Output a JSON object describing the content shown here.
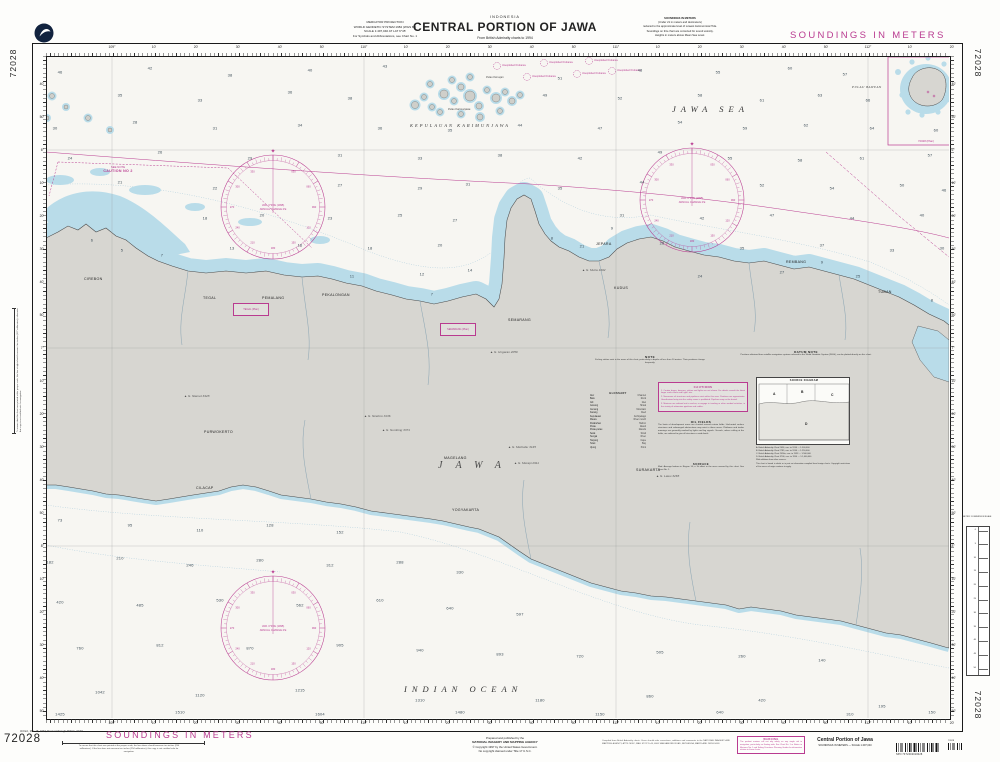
{
  "chart_number": "72028",
  "header": {
    "projection_lines": [
      "MERCATOR PROJECTION",
      "WORLD GEODETIC SYSTEM 1984 (WGS 84)",
      "SCALE 1:497,040 AT LAT 6°45'",
      "For Symbols and Abbreviations, see Chart No. 1"
    ],
    "country": "INDONESIA",
    "title": "CENTRAL PORTION OF JAWA",
    "subtitle": "From British Admiralty charts to 1994",
    "soundings_note_lines": [
      "SOUNDINGS IN METERS",
      "(Under 21 in meters and decimeters)",
      "reduced to the approximate level of Lowest Astronomical Tide.",
      "Soundings on this chart are corrected for sound velocity.",
      "Heights in meters above Mean Sea Level."
    ],
    "banner": "SOUNDINGS IN METERS"
  },
  "margins": {
    "lon_labels": [
      "109°",
      "10'",
      "20'",
      "30'",
      "40'",
      "50'",
      "110°",
      "10'",
      "20'",
      "30'",
      "40'",
      "50'",
      "111°",
      "10'",
      "20'",
      "30'",
      "40'",
      "50'",
      "112°",
      "10'",
      "20'"
    ],
    "lat_labels": [
      "40'",
      "50'",
      "6°",
      "10'",
      "20'",
      "30'",
      "40'",
      "50'",
      "7°",
      "10'",
      "20'",
      "30'",
      "40'",
      "50'",
      "8°",
      "10'",
      "20'",
      "30'",
      "40'",
      "50'"
    ],
    "scale_check": "To ensure that this chart was printed at the proper scale, the line above should measure ten inches (254 millimeters). If the line does not measure ten inches (254 millimeters), this copy is not certified safe for navigation.",
    "scale_check_vertical": "To ensure that this chart was printed at the proper scale, the line at right should measure five inches (127 millimeters); otherwise this copy is not certified safe for navigation.",
    "metric_scale_title": "METRIC CONVERSION SCALE",
    "metric_scale_values": [
      "0",
      "5",
      "10",
      "15",
      "20",
      "25",
      "30",
      "35",
      "40",
      "45",
      "50"
    ]
  },
  "map": {
    "sea_labels": {
      "jawa_sea": "JAWA SEA",
      "indian_ocean": "INDIAN OCEAN",
      "karimunjawa": "KEPULAUAN KARIMUNJAWA",
      "jawa": "JAWA",
      "bawean": "PULAU BAWEAN",
      "bawean_plan": "72028 (Plan)"
    },
    "island_labels": [
      {
        "n": "Pulau Karimunjawa",
        "x": 448,
        "y": 108
      },
      {
        "n": "Pulau Kemujan",
        "x": 486,
        "y": 76
      }
    ],
    "caution_label": {
      "line1": "SEE NOTE",
      "line2": "CAUTION NO 2"
    },
    "ordnance_label": "Unexploded Ordnance",
    "ordnance_points": [
      [
        497,
        66
      ],
      [
        544,
        63
      ],
      [
        589,
        61
      ],
      [
        527,
        77
      ],
      [
        577,
        74
      ],
      [
        612,
        71
      ]
    ],
    "rose": {
      "line1": "VAR. 0°45'E (1995)",
      "line2": "ANNUAL CHANGE 2'E"
    },
    "plan_boxes": [
      {
        "label": "TEGAL (Plan)",
        "x": 233,
        "y": 303
      },
      {
        "label": "SEMARANG (Plan)",
        "x": 440,
        "y": 323
      }
    ],
    "cities": [
      {
        "n": "CIREBON",
        "x": 84,
        "y": 277
      },
      {
        "n": "TEGAL",
        "x": 203,
        "y": 296
      },
      {
        "n": "PEMALANG",
        "x": 262,
        "y": 296
      },
      {
        "n": "PEKALONGAN",
        "x": 322,
        "y": 293
      },
      {
        "n": "SEMARANG",
        "x": 508,
        "y": 318
      },
      {
        "n": "JEPARA",
        "x": 596,
        "y": 242
      },
      {
        "n": "KUDUS",
        "x": 614,
        "y": 286
      },
      {
        "n": "REMBANG",
        "x": 786,
        "y": 260
      },
      {
        "n": "TUBAN",
        "x": 878,
        "y": 290
      },
      {
        "n": "CILACAP",
        "x": 196,
        "y": 486
      },
      {
        "n": "YOGYAKARTA",
        "x": 452,
        "y": 508
      },
      {
        "n": "SURAKARTA",
        "x": 636,
        "y": 468
      },
      {
        "n": "MAGELANG",
        "x": 444,
        "y": 456
      },
      {
        "n": "PURWOKERTO",
        "x": 204,
        "y": 430
      }
    ],
    "peaks": [
      {
        "n": "G. Slamet 3428",
        "x": 184,
        "y": 394
      },
      {
        "n": "G. Sindoro 3136",
        "x": 364,
        "y": 414
      },
      {
        "n": "G. Sumbing 3371",
        "x": 382,
        "y": 428
      },
      {
        "n": "G. Merbabu 3145",
        "x": 508,
        "y": 445
      },
      {
        "n": "G. Merapi 2911",
        "x": 514,
        "y": 461
      },
      {
        "n": "G. Lawu 3265",
        "x": 656,
        "y": 474
      },
      {
        "n": "G. Muria 1602",
        "x": 582,
        "y": 268
      },
      {
        "n": "G. Ungaran 2050",
        "x": 490,
        "y": 350
      }
    ],
    "notes": {
      "note": {
        "title": "NOTE",
        "body": "Fishing stakes exist in the areas of this chart, particularly in depths of less than 10 meters. Their positions change frequently."
      },
      "datum": {
        "title": "DATUM NOTE",
        "body": "Positions obtained from satellite navigation systems referred to the World Geodetic System (WGS), can be plotted directly on this chart."
      },
      "cautions": {
        "title": "CAUTIONS",
        "items": [
          "1. Certain buoys, beacons, stakes and lights are not shown. For details consult the latest larger scale charts and Light Lists.",
          "2. Numerous oil structures and pipelines exist within this area. Positions are approximate. Unauthorized entry into the safety zones is prohibited. Pipelines may not be buried.",
          "3. Mariners are advised not to anchor, or engage in trawling or other seabed activities, in the vicinity of submarine pipelines and cables."
        ]
      },
      "oil": {
        "title": "OIL FIELDS",
        "body": "The limits of development areas are charted around certain fields. Uncharted surface structures and submerged obstructions may exist in these areas. Platforms and tanker moorings are generally marked by lights and fog signals. Vessels, unless calling at the fields, are advised to give all structures a wide berth."
      },
      "surface": {
        "title": "SURFACE",
        "body": "Mud. Average bottom in Region 14; a 1h effect in the area covered by this chart. See Chart No. 1."
      },
      "glossary": {
        "title": "GLOSSARY",
        "items": [
          [
            "Alur",
            "Channel"
          ],
          [
            "Batu",
            "Rock"
          ],
          [
            "Gili",
            "Islet"
          ],
          [
            "Gosong",
            "Shoal"
          ],
          [
            "Gunung",
            "Mountain"
          ],
          [
            "Karang",
            "Reef"
          ],
          [
            "Kepulauan",
            "Archipelago"
          ],
          [
            "Muara",
            "River mouth"
          ],
          [
            "Pelabuhan",
            "Harbor"
          ],
          [
            "Pulau",
            "Island"
          ],
          [
            "Pulau-pulau",
            "Islands"
          ],
          [
            "Selat",
            "Strait"
          ],
          [
            "Sungai",
            "River"
          ],
          [
            "Tanjung",
            "Cape"
          ],
          [
            "Teluk",
            "Bay"
          ],
          [
            "Ujung",
            "Point"
          ]
        ]
      },
      "source": {
        "title": "SOURCE DIAGRAM",
        "regions": [
          "A",
          "B",
          "C",
          "D"
        ],
        "lines": [
          "A. British Admiralty Chart 2056, corr. to 1994 — 1:500,000",
          "B. British Admiralty Chart 2785, corr. to 1994 — 1:250,000",
          "C. British Admiralty Chart 2056a, corr. to 1993 — 1:500,000",
          "D. British Admiralty Chart 3706, corr. to 1994 — 1:1,000,000"
        ],
        "note": "With additions from other sources.",
        "footnote": "This chart is based in whole or in part on information compiled from foreign charts. Copyright restrictions of the source of origin continue to apply."
      }
    },
    "soundings": [
      [
        60,
        72,
        "46"
      ],
      [
        150,
        68,
        "42"
      ],
      [
        230,
        75,
        "38"
      ],
      [
        310,
        70,
        "40"
      ],
      [
        385,
        66,
        "43"
      ],
      [
        560,
        78,
        "51"
      ],
      [
        640,
        70,
        "48"
      ],
      [
        718,
        72,
        "55"
      ],
      [
        790,
        68,
        "60"
      ],
      [
        845,
        74,
        "57"
      ],
      [
        45,
        98,
        "37"
      ],
      [
        120,
        95,
        "35"
      ],
      [
        200,
        100,
        "33"
      ],
      [
        290,
        92,
        "36"
      ],
      [
        350,
        98,
        "38"
      ],
      [
        545,
        95,
        "49"
      ],
      [
        620,
        98,
        "52"
      ],
      [
        700,
        95,
        "58"
      ],
      [
        762,
        100,
        "61"
      ],
      [
        820,
        95,
        "63"
      ],
      [
        868,
        100,
        "66"
      ],
      [
        55,
        128,
        "30"
      ],
      [
        135,
        122,
        "28"
      ],
      [
        215,
        128,
        "31"
      ],
      [
        300,
        125,
        "34"
      ],
      [
        380,
        128,
        "36"
      ],
      [
        450,
        130,
        "35"
      ],
      [
        520,
        125,
        "44"
      ],
      [
        600,
        128,
        "47"
      ],
      [
        680,
        122,
        "54"
      ],
      [
        745,
        128,
        "59"
      ],
      [
        806,
        125,
        "62"
      ],
      [
        872,
        128,
        "64"
      ],
      [
        936,
        130,
        "60"
      ],
      [
        70,
        158,
        "24"
      ],
      [
        160,
        152,
        "26"
      ],
      [
        250,
        158,
        "29"
      ],
      [
        340,
        155,
        "31"
      ],
      [
        420,
        158,
        "33"
      ],
      [
        500,
        155,
        "38"
      ],
      [
        580,
        158,
        "42"
      ],
      [
        660,
        152,
        "49"
      ],
      [
        730,
        158,
        "55"
      ],
      [
        800,
        160,
        "58"
      ],
      [
        862,
        158,
        "61"
      ],
      [
        930,
        155,
        "57"
      ],
      [
        120,
        182,
        "21"
      ],
      [
        215,
        188,
        "22"
      ],
      [
        340,
        185,
        "27"
      ],
      [
        420,
        188,
        "29"
      ],
      [
        468,
        184,
        "31"
      ],
      [
        560,
        188,
        "35"
      ],
      [
        642,
        182,
        "44"
      ],
      [
        762,
        185,
        "52"
      ],
      [
        832,
        188,
        "54"
      ],
      [
        902,
        185,
        "50"
      ],
      [
        944,
        190,
        "46"
      ],
      [
        205,
        218,
        "18"
      ],
      [
        262,
        215,
        "20"
      ],
      [
        330,
        218,
        "23"
      ],
      [
        400,
        215,
        "25"
      ],
      [
        455,
        220,
        "27"
      ],
      [
        622,
        215,
        "31"
      ],
      [
        702,
        218,
        "42"
      ],
      [
        772,
        215,
        "47"
      ],
      [
        852,
        218,
        "44"
      ],
      [
        922,
        215,
        "40"
      ],
      [
        942,
        248,
        "30"
      ],
      [
        232,
        248,
        "13"
      ],
      [
        300,
        245,
        "16"
      ],
      [
        370,
        248,
        "18"
      ],
      [
        440,
        245,
        "20"
      ],
      [
        582,
        246,
        "21"
      ],
      [
        662,
        243,
        "26"
      ],
      [
        742,
        248,
        "35"
      ],
      [
        822,
        245,
        "37"
      ],
      [
        892,
        250,
        "33"
      ],
      [
        352,
        276,
        "11"
      ],
      [
        422,
        274,
        "12"
      ],
      [
        470,
        270,
        "14"
      ],
      [
        700,
        276,
        "24"
      ],
      [
        782,
        272,
        "27"
      ],
      [
        858,
        276,
        "25"
      ],
      [
        122,
        250,
        "5"
      ],
      [
        162,
        255,
        "7"
      ],
      [
        92,
        240,
        "6"
      ],
      [
        432,
        294,
        "7"
      ],
      [
        552,
        238,
        "8"
      ],
      [
        612,
        228,
        "9"
      ],
      [
        822,
        262,
        "9"
      ],
      [
        932,
        300,
        "8"
      ],
      [
        60,
        520,
        "73"
      ],
      [
        130,
        525,
        "95"
      ],
      [
        200,
        530,
        "110"
      ],
      [
        270,
        525,
        "128"
      ],
      [
        340,
        532,
        "152"
      ],
      [
        50,
        562,
        "182"
      ],
      [
        120,
        558,
        "210"
      ],
      [
        190,
        565,
        "246"
      ],
      [
        260,
        560,
        "280"
      ],
      [
        330,
        565,
        "312"
      ],
      [
        400,
        562,
        "288"
      ],
      [
        460,
        572,
        "330"
      ],
      [
        60,
        602,
        "420"
      ],
      [
        140,
        605,
        "485"
      ],
      [
        220,
        600,
        "530"
      ],
      [
        300,
        605,
        "562"
      ],
      [
        380,
        600,
        "610"
      ],
      [
        450,
        608,
        "640"
      ],
      [
        520,
        614,
        "597"
      ],
      [
        80,
        648,
        "760"
      ],
      [
        160,
        645,
        "812"
      ],
      [
        250,
        648,
        "870"
      ],
      [
        340,
        645,
        "905"
      ],
      [
        420,
        650,
        "940"
      ],
      [
        500,
        654,
        "893"
      ],
      [
        580,
        656,
        "720"
      ],
      [
        660,
        652,
        "505"
      ],
      [
        742,
        656,
        "260"
      ],
      [
        822,
        660,
        "140"
      ],
      [
        100,
        692,
        "1042"
      ],
      [
        200,
        695,
        "1120"
      ],
      [
        300,
        690,
        "1215"
      ],
      [
        420,
        700,
        "1310"
      ],
      [
        540,
        700,
        "1180"
      ],
      [
        650,
        696,
        "860"
      ],
      [
        762,
        700,
        "420"
      ],
      [
        882,
        706,
        "195"
      ],
      [
        60,
        714,
        "1425"
      ],
      [
        180,
        712,
        "1510"
      ],
      [
        320,
        714,
        "1604"
      ],
      [
        460,
        712,
        "1480"
      ],
      [
        600,
        714,
        "1150"
      ],
      [
        720,
        712,
        "640"
      ],
      [
        850,
        714,
        "310"
      ],
      [
        932,
        712,
        "150"
      ]
    ]
  },
  "footer": {
    "edition_note": "3rd Ed., Mar. 15, 1997; Revised through NM No. 19/97",
    "chart_number": "72028",
    "banner": "SOUNDINGS IN METERS",
    "publisher_lines": [
      "Prepared and published by the",
      "NATIONAL IMAGERY AND MAPPING AGENCY",
      "© Copyright 1997 by the United States Government.",
      "No copyright claimed under Title 17 U.S.C."
    ],
    "compilation_note": "Compiled from British Admiralty charts. Users should refer corrections, additions and comments to the NATIONAL IMAGERY AND MAPPING AGENCY, ATTN: MISC, MAIL STOP D-44, 4600 SANGAMORE ROAD, BETHESDA, MARYLAND 20816-5003.",
    "warning": {
      "title": "WARNING",
      "body": "The prudent mariner will not rely solely on any single aid to navigation, particularly on floating aids. See Chart No. 1 or Notice to Mariners No. 1 and Sailing Directions Planning Guides for information relative to these charts."
    },
    "title_block": {
      "title": "Central Portion of Jawa",
      "subtitle": "SOUNDINGS IN METERS — SCALE 1:497,040"
    },
    "barcode_text": "SPN 7F72402010028",
    "barcode2_text": "72028"
  }
}
